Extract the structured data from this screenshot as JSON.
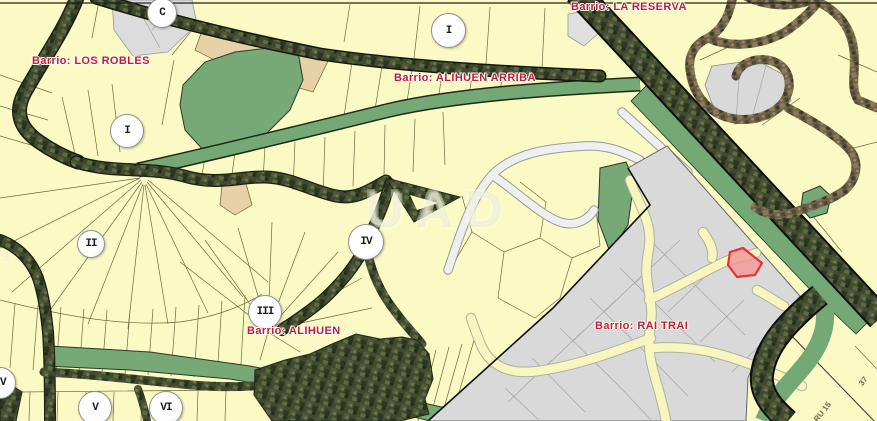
{
  "map": {
    "barrios": [
      {
        "name": "los-robles",
        "label": "Barrio: LOS ROBLES"
      },
      {
        "name": "alihuen-arriba",
        "label": "Barrio: ALIHUEN ARRIBA"
      },
      {
        "name": "la-reserva",
        "label": "Barrio: LA RESERVA"
      },
      {
        "name": "alihuen",
        "label": "Barrio: ALIHUEN"
      },
      {
        "name": "rai-trai",
        "label": "Barrio: RAI TRAI"
      }
    ],
    "markers": [
      {
        "label": "C"
      },
      {
        "label": "I"
      },
      {
        "label": "I"
      },
      {
        "label": "II"
      },
      {
        "label": "III"
      },
      {
        "label": "IV"
      },
      {
        "label": "IV"
      },
      {
        "label": "V"
      },
      {
        "label": "VI"
      }
    ],
    "street_labels": [
      {
        "text": "37"
      },
      {
        "text": "RU 15"
      },
      {
        "text": "S"
      }
    ],
    "watermark": "UAD",
    "colors": {
      "background": "#fbf9c4",
      "green_area": "#76a976",
      "gray_zone": "#d9d9d9",
      "tan_area": "#e7d2a8",
      "road_white": "#efefef",
      "label_red": "#bb1e43",
      "selected_parcel_fill": "#f29999",
      "selected_parcel_stroke": "#e03434"
    }
  }
}
